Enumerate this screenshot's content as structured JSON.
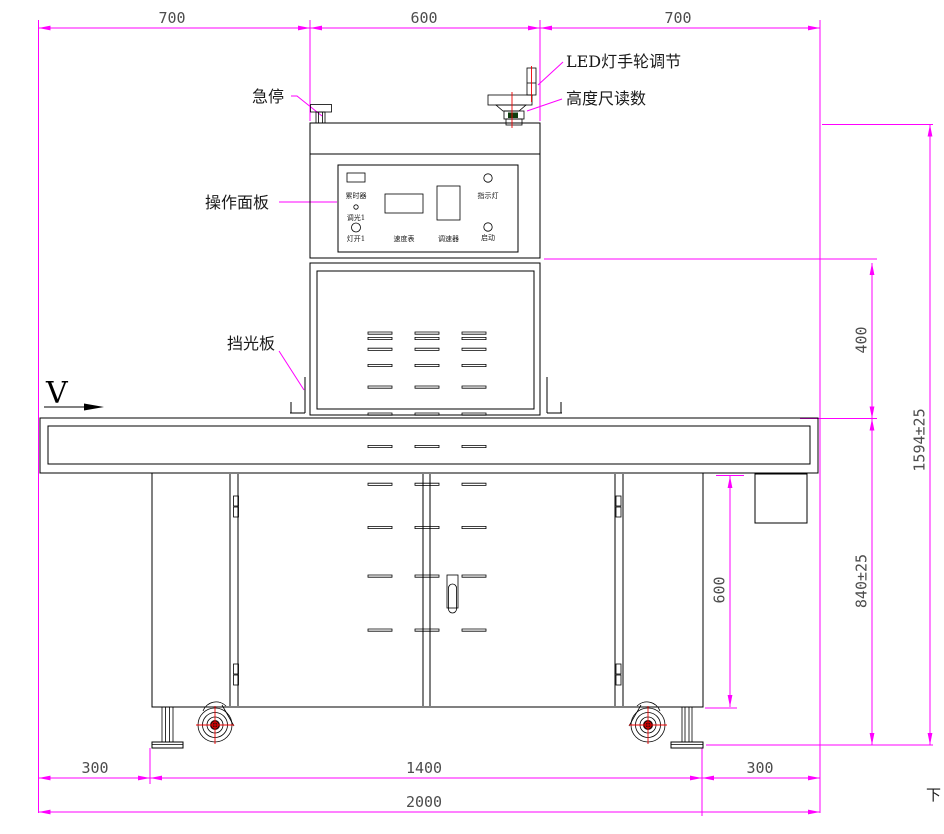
{
  "drawing": {
    "title_hint": "Front elevation of LED curing conveyor machine",
    "labels": {
      "emergency_stop": "急停",
      "led_handwheel": "LED灯手轮调节",
      "height_gauge": "高度尺读数",
      "operation_panel": "操作面板",
      "light_shield": "挡光板",
      "direction_marker": "V",
      "page_char": "下"
    },
    "panel": {
      "timer": "累时器",
      "dimmer1": "调光1",
      "lamp_on1": "灯开1",
      "speed_meter": "速度表",
      "speed_controller": "调速器",
      "indicator_light": "指示灯",
      "start": "启动"
    },
    "dims": {
      "top_left": "700",
      "top_middle": "600",
      "top_right": "700",
      "right_upper": "400",
      "right_total": "1594±25",
      "right_lower": "840±25",
      "cabinet_height": "600",
      "bottom_left": "300",
      "bottom_middle": "1400",
      "bottom_right": "300",
      "bottom_total": "2000"
    },
    "colors": {
      "dimension": "#ff00ff",
      "outline": "#000000",
      "centerline": "#ee0000",
      "gauge_fill": "#0d3d0d",
      "dim_text": "#4d4d4d"
    }
  }
}
